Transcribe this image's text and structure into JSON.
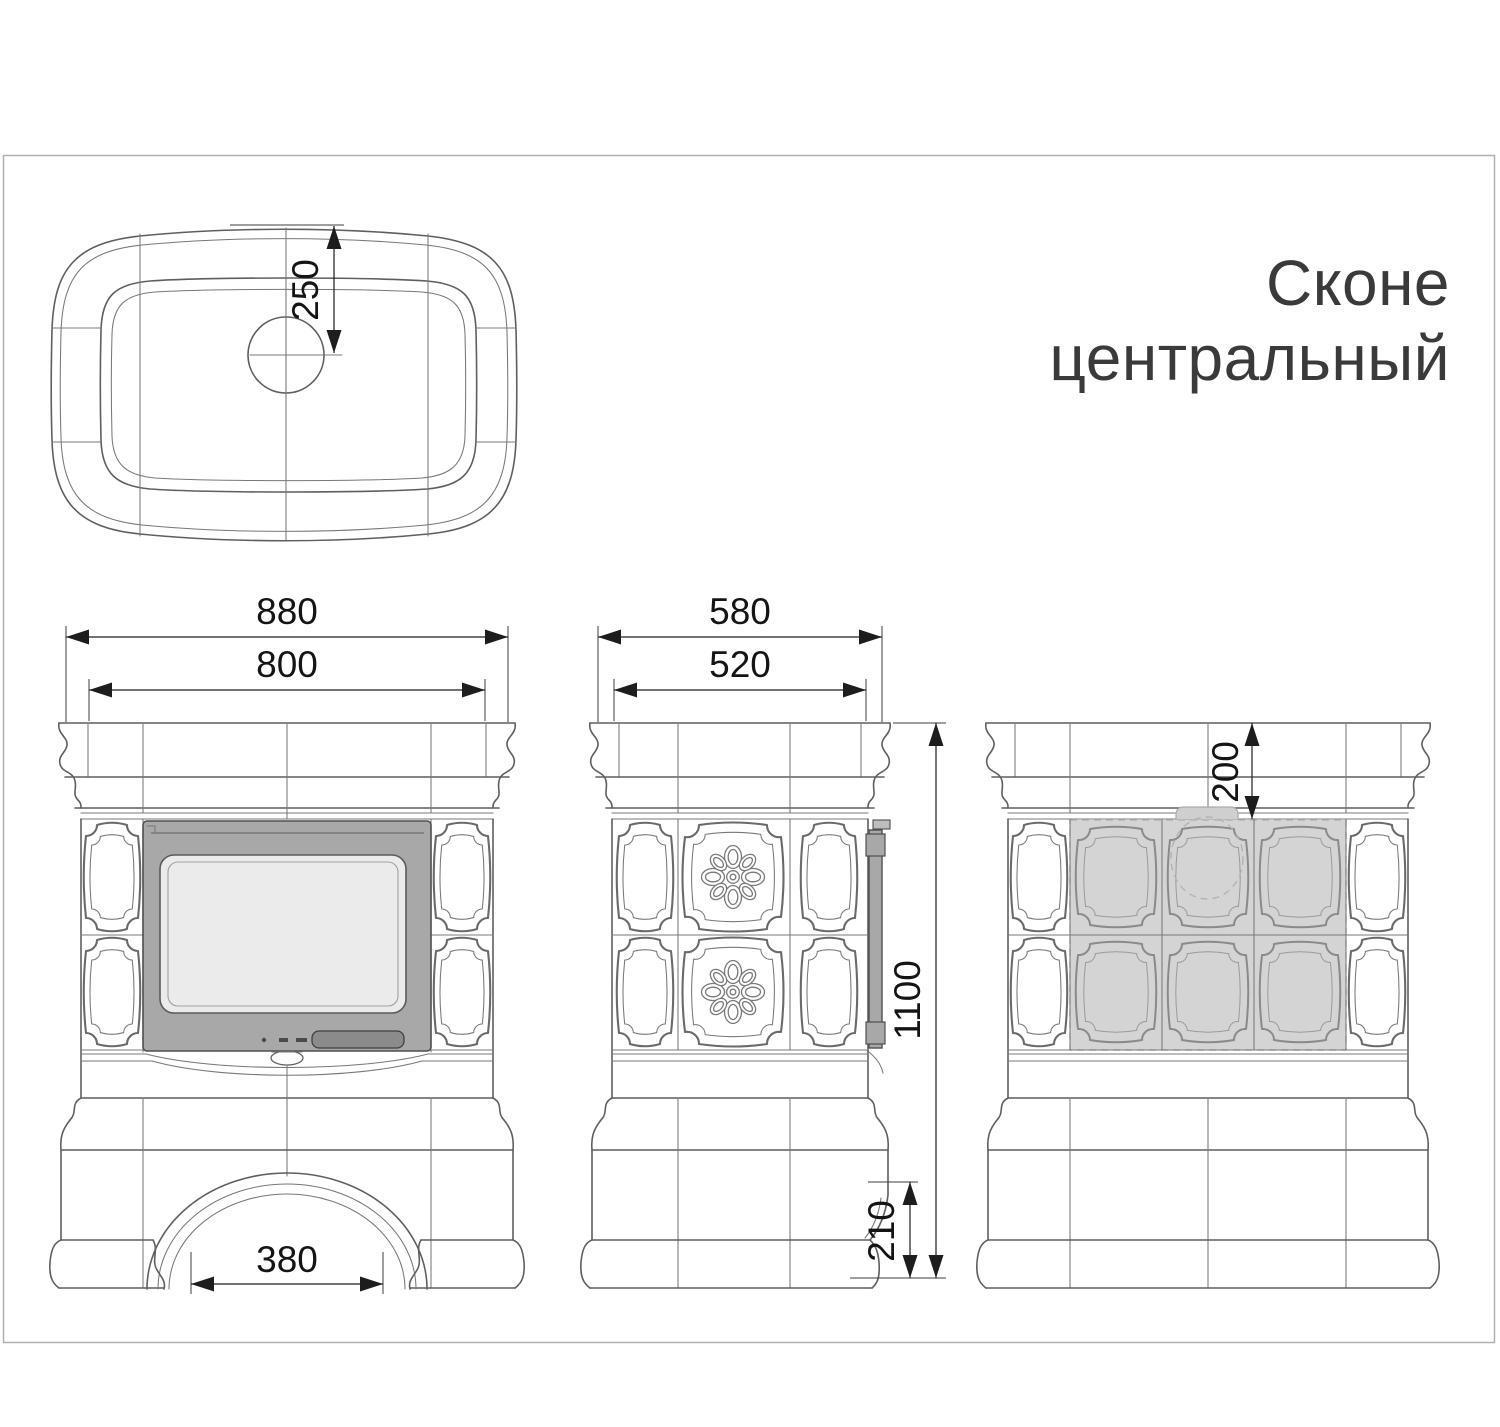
{
  "title": {
    "line1": "Сконе",
    "line2": "центральный"
  },
  "dimensions": {
    "flue_offset_top_view": "250",
    "front_outer_width": "880",
    "front_inner_width": "800",
    "arch_opening_width": "380",
    "side_outer_depth": "580",
    "side_inner_depth": "520",
    "total_height": "1100",
    "base_notch_height": "210",
    "flue_offset_back_view": "200"
  },
  "colors": {
    "outline": "#5f5f5f",
    "dimension": "#1d1d1d",
    "door_frame": "#a8a8a8",
    "door_glass": "#ebebeb",
    "door_handle": "#8b8b8b",
    "shaded_tiles": "#d4d4d4",
    "page_frame": "#b0b0b0",
    "title_text": "#3a3a3a"
  }
}
